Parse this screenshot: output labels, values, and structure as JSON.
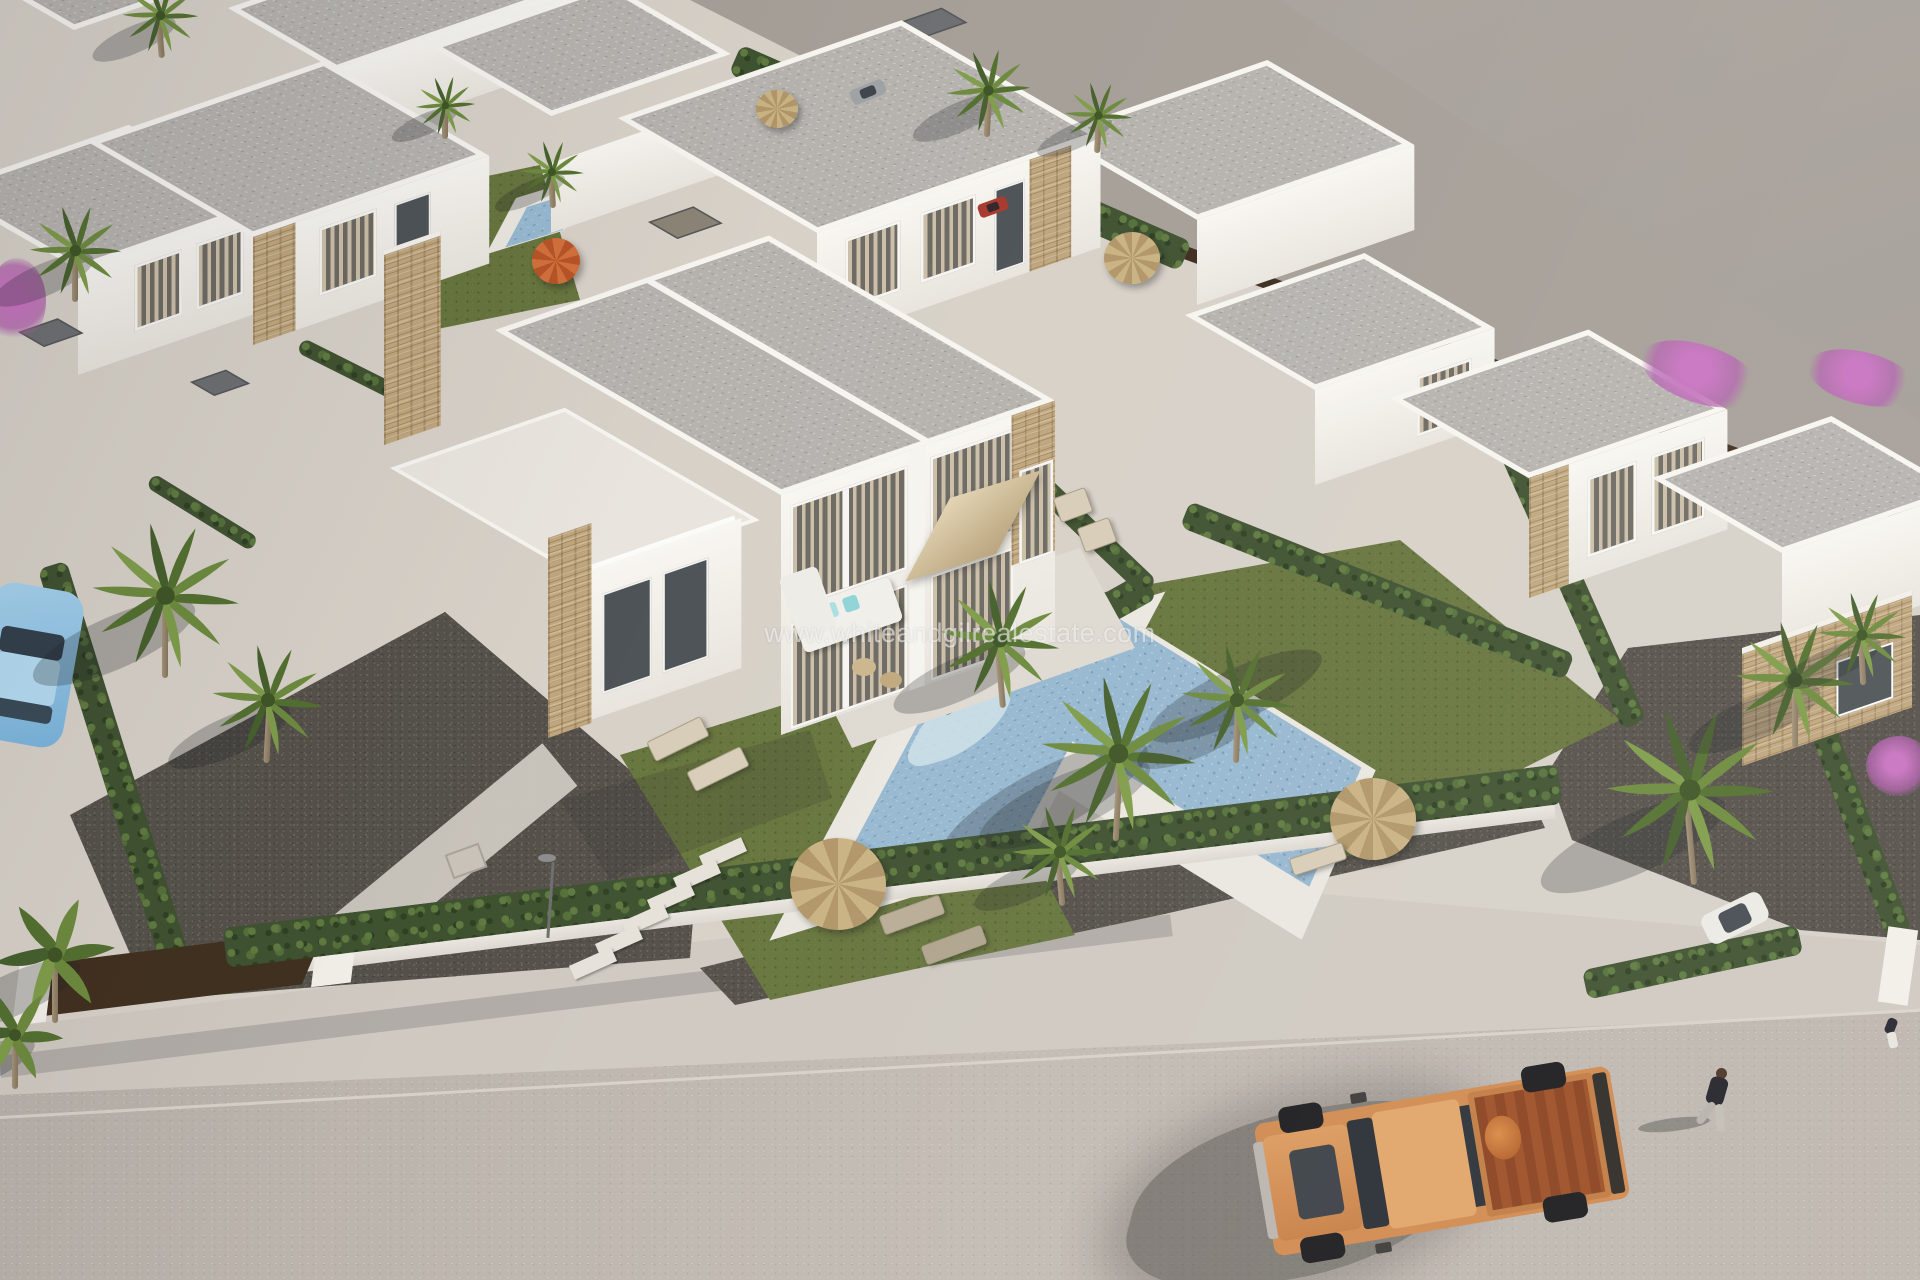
{
  "image": {
    "width": 1920,
    "height": 1280,
    "type": "3d-architectural-render",
    "description": "Aerial 3D render of a modern Mediterranean villa development: white flat-roofed houses with stone-clad accents, private pools with sun decks, palm trees, cypress hedges, gravel gardens, a white perimeter wall with brown gates along a wide street where an orange pickup truck is parked and a pedestrian walks; vacant grey land in the upper right."
  },
  "watermark": {
    "text": "www.whiteandgilrealestate.com"
  },
  "colors": {
    "concrete": "#d7d1c8",
    "ground-far": "#a69f98",
    "street": "#bcb5ae",
    "sidewalk": "#cfc9c1",
    "wall-white": "#f5f3ee",
    "wall-shade": "#e3dfd8",
    "roof-gray": "#b6b3af",
    "stone": "#c0a67c",
    "hedge": "#3f5230",
    "grass": "#67753e",
    "gravel": "#55514a",
    "pool-water": "#97b8d0",
    "pool-deck": "#eae7e0",
    "palm": "#5d7a35",
    "truck-orange": "#d08a4f",
    "truck-bed": "#8a421e",
    "car-blue": "#8fc2e6",
    "gate-brown": "#41301f",
    "bougainvillea": "#b25fae",
    "watermark": "rgba(255,255,255,0.55)"
  },
  "scene": {
    "objects": [
      "hero-semi-detached-villa",
      "white-villas",
      "flat-gray-roofs",
      "stone-clad-piers",
      "curtained-windows",
      "roof-terrace",
      "square-patio-parasol",
      "outdoor-corner-sofa",
      "sun-loungers",
      "private-pool-left",
      "private-pool-right",
      "small-pool-top",
      "thatched-parasols",
      "orange-parasol",
      "palm-trees",
      "banana-plants",
      "cypress-hedges",
      "lawns",
      "gravel-gardens",
      "stepping-stones",
      "street-lamp",
      "perimeter-wall",
      "brown-gates",
      "sidewalk",
      "street",
      "vacant-land",
      "orange-pickup-truck",
      "light-blue-car",
      "white-car",
      "red-car",
      "gray-car",
      "pedestrian",
      "bougainvillea"
    ]
  }
}
